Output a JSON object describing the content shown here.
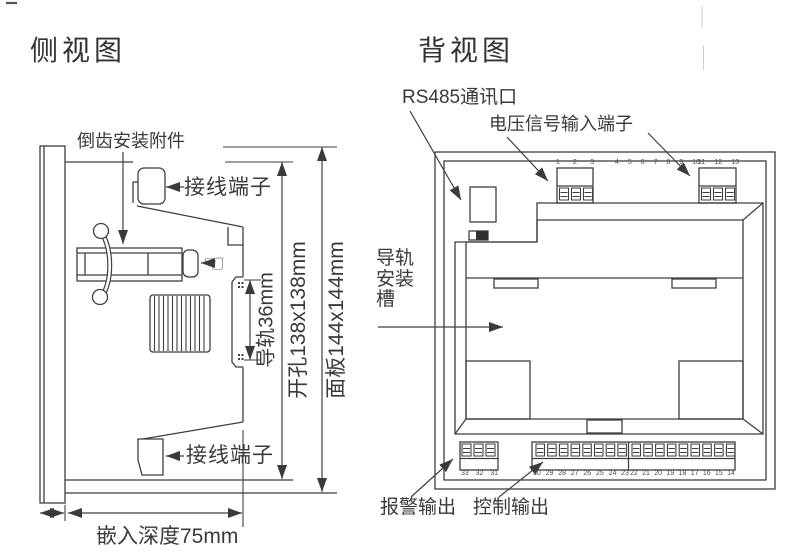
{
  "side_view": {
    "title": "侧视图",
    "labels": {
      "mount_accessory": "倒齿安装附件",
      "terminal_top": "接线端子",
      "terminal_bottom": "接线端子",
      "rail_dim": "导轨36mm",
      "cutout_dim": "开孔138x138mm",
      "panel_dim": "面板144x144mm",
      "depth_dim": "嵌入深度75mm"
    }
  },
  "back_view": {
    "title": "背视图",
    "labels": {
      "rs485_port": "RS485通讯口",
      "voltage_input": "电压信号输入端子",
      "rail_slot": "导轨安装槽",
      "alarm_output": "报警输出",
      "control_output": "控制输出"
    },
    "terminals": {
      "top_left": [
        "1",
        "2",
        "3"
      ],
      "top_middle": [
        "4",
        "5",
        "6",
        "7",
        "8",
        "9",
        "10"
      ],
      "top_right": [
        "11",
        "12",
        "13"
      ],
      "bottom_left": [
        "33",
        "32",
        "31"
      ],
      "bottom_middle": [
        "30",
        "29",
        "28",
        "27",
        "26",
        "25",
        "24",
        "23"
      ],
      "bottom_right": [
        "22",
        "21",
        "20",
        "19",
        "18",
        "17",
        "16",
        "15",
        "14"
      ]
    }
  },
  "icons": {
    "hand_pointer": "☜"
  },
  "colors": {
    "line": "#3f3f3f",
    "text": "#3a3a3a",
    "switch_fill": "#2f2f2f"
  }
}
